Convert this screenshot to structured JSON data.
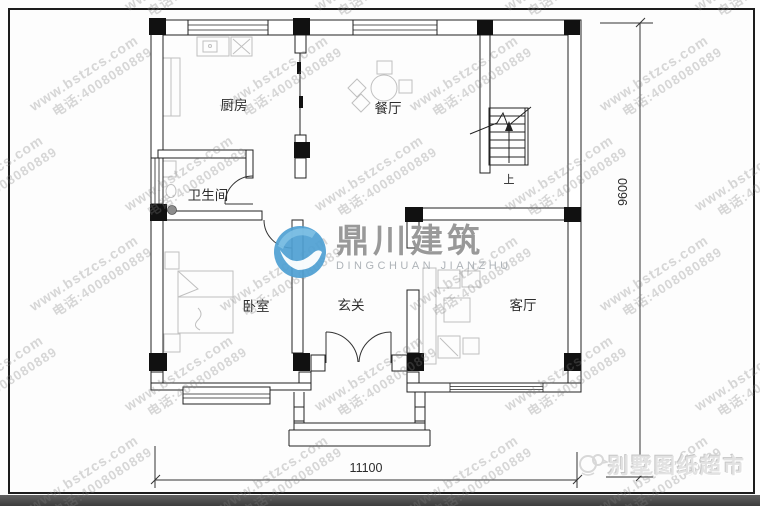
{
  "watermark": {
    "site": "www.bstzcs.com",
    "phone": "电话:4008080889"
  },
  "brand": {
    "cn": "鼎川建筑",
    "en": "DINGCHUAN JIANZHU",
    "circle_color": "#4e9fd2"
  },
  "corner_brand": {
    "text": "别墅图纸超市"
  },
  "plan": {
    "rooms": {
      "kitchen": "厨房",
      "dining": "餐厅",
      "bathroom": "卫生间",
      "bedroom": "卧室",
      "foyer": "玄关",
      "living": "客厅"
    },
    "stairs_up": "上",
    "dim_width": "11100",
    "dim_height": "9600"
  }
}
